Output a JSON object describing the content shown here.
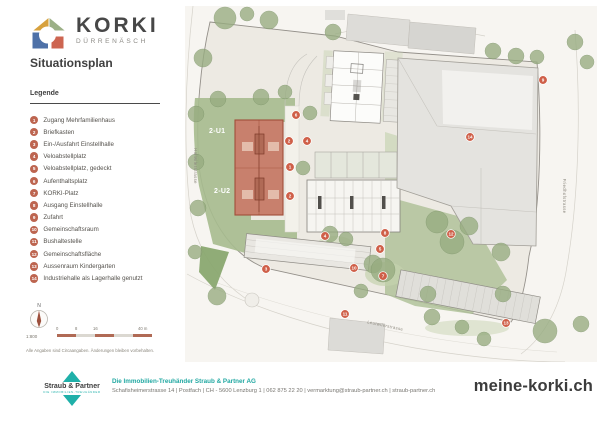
{
  "header": {
    "logo_title": "KORKI",
    "logo_subtitle": "DÜRRENÄSCH"
  },
  "title": "Situationsplan",
  "legend": {
    "title": "Legende",
    "items": [
      {
        "number": "1",
        "label": "Zugang Mehrfamilienhaus"
      },
      {
        "number": "2",
        "label": "Briefkasten"
      },
      {
        "number": "3",
        "label": "Ein-/Ausfahrt Einstellhalle"
      },
      {
        "number": "4",
        "label": "Veloabstellplatz"
      },
      {
        "number": "5",
        "label": "Veloabstellplatz, gedeckt"
      },
      {
        "number": "6",
        "label": "Aufenthaltsplatz"
      },
      {
        "number": "7",
        "label": "KORKI-Platz"
      },
      {
        "number": "8",
        "label": "Ausgang Einstellhalle"
      },
      {
        "number": "9",
        "label": "Zufahrt"
      },
      {
        "number": "10",
        "label": "Gemeinschaftsraum"
      },
      {
        "number": "11",
        "label": "Bushaltestelle"
      },
      {
        "number": "12",
        "label": "Gemeinschaftsfläche"
      },
      {
        "number": "13",
        "label": "Aussenraum Kindergarten"
      },
      {
        "number": "14",
        "label": "Industriehalle als Lagerhalle genutzt"
      }
    ]
  },
  "map": {
    "building_labels": [
      {
        "text": "2-U1",
        "x": 24,
        "y": 127
      },
      {
        "text": "2-U2",
        "x": 29,
        "y": 187
      }
    ],
    "street_labels": [
      {
        "name": "Hallwilerstrasse",
        "x": 9,
        "y": 160,
        "rotate": 90
      },
      {
        "name": "Friedhofstrasse",
        "x": 378,
        "y": 190,
        "rotate": 90
      },
      {
        "name": "Leutwilerstrasse",
        "x": 200,
        "y": 321,
        "rotate": 12
      }
    ],
    "markers": [
      {
        "number": "6",
        "x": 111,
        "y": 109
      },
      {
        "number": "2",
        "x": 104,
        "y": 135
      },
      {
        "number": "4",
        "x": 122,
        "y": 135
      },
      {
        "number": "1",
        "x": 105,
        "y": 161
      },
      {
        "number": "2",
        "x": 105,
        "y": 190
      },
      {
        "number": "9",
        "x": 358,
        "y": 74
      },
      {
        "number": "14",
        "x": 285,
        "y": 131
      },
      {
        "number": "12",
        "x": 266,
        "y": 228
      },
      {
        "number": "8",
        "x": 200,
        "y": 227
      },
      {
        "number": "5",
        "x": 195,
        "y": 243
      },
      {
        "number": "4",
        "x": 140,
        "y": 230
      },
      {
        "number": "10",
        "x": 169,
        "y": 262
      },
      {
        "number": "7",
        "x": 198,
        "y": 270
      },
      {
        "number": "3",
        "x": 81,
        "y": 263
      },
      {
        "number": "11",
        "x": 160,
        "y": 308
      },
      {
        "number": "13",
        "x": 321,
        "y": 317
      }
    ]
  },
  "scale": {
    "compass": "N",
    "ratio": "1:800",
    "ticks": [
      "0",
      "8",
      "16",
      "40 m"
    ],
    "note": "Alle Angaben sind Circaangaben. Änderungen bleiben vorbehalten."
  },
  "footer": {
    "brand": "Straub & Partner",
    "tagline": "DIE IMMOBILIEN-TREUHÄNDER",
    "company": "Die Immobilien-Treuhänder Straub & Partner AG",
    "address": "Schafisheimerstrasse 14 | Postfach | CH - 5600 Lenzburg 1 | 062 875 22 20 | vermarktung@straub-partner.ch | straub-partner.ch",
    "website": "meine-korki.ch"
  },
  "colors": {
    "accent": "#c2604b",
    "brand_teal": "#1fb0a9",
    "building_fill": "#c8806d",
    "green": "#a6bb8e"
  }
}
